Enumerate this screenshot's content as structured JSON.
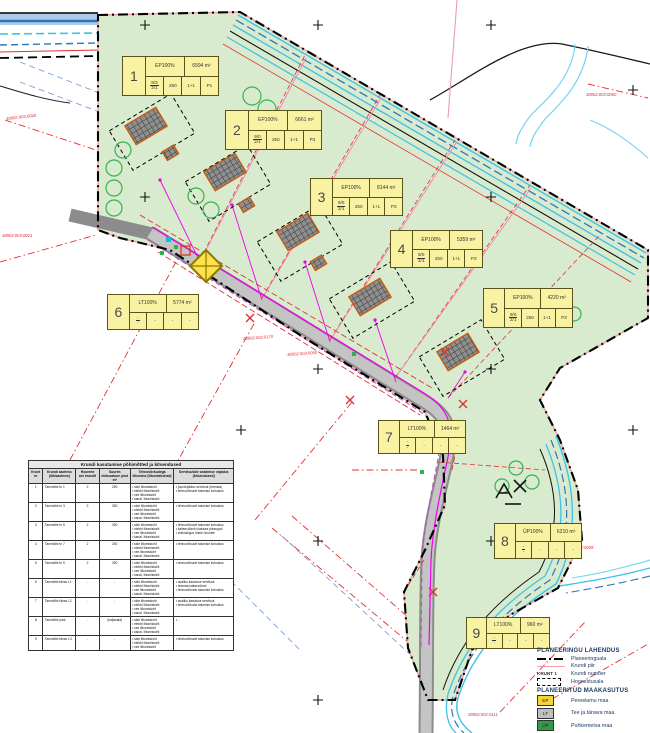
{
  "map": {
    "title_hint": "Detailplaneeringu põhijoonis",
    "plot_labels": [
      {
        "num": "1",
        "use": "EP100%",
        "area": "6594 m²",
        "f_top": "9/3",
        "f_bot": "2/1",
        "c1": "250",
        "c2": "1+1",
        "c3": "P1",
        "x": 122,
        "y": 56,
        "w": 97,
        "h": 40
      },
      {
        "num": "2",
        "use": "EP100%",
        "area": "6661 m²",
        "f_top": "9/0",
        "f_bot": "2/1",
        "c1": "250",
        "c2": "1+1",
        "c3": "P3",
        "x": 225,
        "y": 110,
        "w": 97,
        "h": 40
      },
      {
        "num": "3",
        "use": "EP100%",
        "area": "8144 m²",
        "f_top": "9/0",
        "f_bot": "2/1",
        "c1": "250",
        "c2": "1+1",
        "c3": "P3",
        "x": 310,
        "y": 178,
        "w": 93,
        "h": 38
      },
      {
        "num": "4",
        "use": "EP100%",
        "area": "5359 m²",
        "f_top": "9/0",
        "f_bot": "2/1",
        "c1": "250",
        "c2": "1+1",
        "c3": "P3",
        "x": 390,
        "y": 230,
        "w": 93,
        "h": 38
      },
      {
        "num": "5",
        "use": "EP100%",
        "area": "4220 m²",
        "f_top": "9/0",
        "f_bot": "2/1",
        "c1": "250",
        "c2": "1+1",
        "c3": "P3",
        "x": 483,
        "y": 288,
        "w": 90,
        "h": 40
      },
      {
        "num": "6",
        "use": "LT100%",
        "area": "5774 m²",
        "f_top": "-",
        "f_bot": "-",
        "c1": "-",
        "c2": "-",
        "c3": "-",
        "x": 107,
        "y": 294,
        "w": 92,
        "h": 36
      },
      {
        "num": "7",
        "use": "LT100%",
        "area": "1464 m²",
        "f_top": "-",
        "f_bot": "-",
        "c1": "-",
        "c2": "-",
        "c3": "-",
        "x": 378,
        "y": 420,
        "w": 88,
        "h": 34
      },
      {
        "num": "8",
        "use": "ÜP100%",
        "area": "6210 m²",
        "f_top": "-",
        "f_bot": "-",
        "c1": "-",
        "c2": "-",
        "c3": "-",
        "x": 494,
        "y": 523,
        "w": 88,
        "h": 36
      },
      {
        "num": "9",
        "use": "LT100%",
        "area": "960 m²",
        "f_top": "-",
        "f_bot": "-",
        "c1": "-",
        "c2": "-",
        "c3": "-",
        "x": 466,
        "y": 617,
        "w": 84,
        "h": 32
      }
    ],
    "cadastral_labels": [
      {
        "t": "38902:003:0040",
        "x": 6,
        "y": 116,
        "r": -6
      },
      {
        "t": "38902:003:0021",
        "x": 2,
        "y": 233,
        "r": 0
      },
      {
        "t": "38902:002:0170",
        "x": 243,
        "y": 336,
        "r": -4
      },
      {
        "t": "38902:003:0050",
        "x": 287,
        "y": 352,
        "r": -4
      },
      {
        "t": "38902:003:0060",
        "x": 586,
        "y": 92,
        "r": 0
      },
      {
        "t": "38902:002:0009",
        "x": 563,
        "y": 545,
        "r": 0
      },
      {
        "t": "38902:002:0111",
        "x": 468,
        "y": 712,
        "r": 0
      }
    ]
  },
  "table": {
    "title": "Krundi kasutamise põhimõtted ja kitsendused",
    "headers": [
      "Krunt nr",
      "Krundi aadress (lähiaadress)",
      "Hoonete arv krundil",
      "Suurim ehitusalune pind m²",
      "Tehnovõrkudega liitumine (liitumiskohad)",
      "Servituutide seadmise vajadus (kitsendused)"
    ],
    "rows": [
      {
        "nr": "1",
        "aadress": "Tammiõie tn 1",
        "hooneid": "2",
        "pind": "250",
        "liitumised": [
          "side liitumiskoht",
          "elektri liitumiskoht",
          "vee liitumiskoht",
          "kanal. liitumiskoht"
        ],
        "servituudid": [
          "juurdepääsu servituut (teemaa)",
          "tehnovõrkude talumise kohustus"
        ]
      },
      {
        "nr": "2",
        "aadress": "Tammiõie tn 3",
        "hooneid": "2",
        "pind": "250",
        "liitumised": [
          "side liitumiskoht",
          "elektri liitumiskoht",
          "vee liitumiskoht",
          "kanal. liitumiskoht"
        ],
        "servituudid": [
          "tehnovõrkude talumise kohustus"
        ]
      },
      {
        "nr": "3",
        "aadress": "Tammiõie tn 5",
        "hooneid": "2",
        "pind": "250",
        "liitumised": [
          "side liitumiskoht",
          "elektri liitumiskoht",
          "vee liitumiskoht",
          "kanal. liitumiskoht"
        ],
        "servituudid": [
          "tehnovõrkude talumise kohustus",
          "kaitsevööndi ulatuses piirangud",
          "ehitusõigus ühele hoonele"
        ]
      },
      {
        "nr": "4",
        "aadress": "Tammiõie tn 7",
        "hooneid": "2",
        "pind": "250",
        "liitumised": [
          "side liitumiskoht",
          "elektri liitumiskoht",
          "vee liitumiskoht",
          "kanal. liitumiskoht"
        ],
        "servituudid": [
          "tehnovõrkude talumise kohustus"
        ]
      },
      {
        "nr": "5",
        "aadress": "Tammiõie tn 9",
        "hooneid": "2",
        "pind": "250",
        "liitumised": [
          "side liitumiskoht",
          "elektri liitumiskoht",
          "vee liitumiskoht",
          "kanal. liitumiskoht"
        ],
        "servituudid": [
          "tehnovõrkude talumise kohustus"
        ]
      },
      {
        "nr": "6",
        "aadress": "Tammiõie tänav L1",
        "hooneid": "-",
        "pind": "-",
        "liitumised": [
          "side liitumiskoht",
          "elektri liitumiskoht",
          "vee liitumiskoht",
          "kanal. liitumiskoht"
        ],
        "servituudid": [
          "avaliku kasutuse servituut",
          "teemaa kaitsevöönd",
          "tehnovõrkude talumise kohustus"
        ]
      },
      {
        "nr": "7",
        "aadress": "Tammiõie tänav L2",
        "hooneid": "-",
        "pind": "-",
        "liitumised": [
          "side liitumiskoht",
          "elektri liitumiskoht",
          "vee liitumiskoht",
          "kanal. liitumiskoht"
        ],
        "servituudid": [
          "avaliku kasutuse servituut",
          "tehnovõrkude talumise kohustus"
        ]
      },
      {
        "nr": "8",
        "aadress": "Tammiõie park",
        "hooneid": "-",
        "pind": "(haljasala)",
        "liitumised": [
          "side liitumiskoht",
          "elektri liitumiskoht",
          "vee liitumiskoht",
          "kanal. liitumiskoht"
        ],
        "servituudid": [
          "-"
        ]
      },
      {
        "nr": "9",
        "aadress": "Tammiõie tänav L3",
        "hooneid": "-",
        "pind": "-",
        "liitumised": [
          "side liitumiskoht",
          "elektri liitumiskoht",
          "vee liitumiskoht"
        ],
        "servituudid": [
          "tehnovõrkude talumise kohustus"
        ]
      }
    ]
  },
  "legend": {
    "heading1": "PLANEERINGU LAHENDUS",
    "items1": [
      {
        "type": "dashdot",
        "label": "Planeeringuala"
      },
      {
        "type": "pink",
        "label": "Krundi piir"
      },
      {
        "type": "krunt",
        "symbol_text": "KRUNT 1",
        "label": "Krundi number"
      },
      {
        "type": "dashbox",
        "label": "Hoonestusala"
      }
    ],
    "heading2": "PLANEERITUD MAAKASUTUS",
    "items2": [
      {
        "code": "EP",
        "color": "#f2d437",
        "label": "Pereelamu maa"
      },
      {
        "code": "LT",
        "color": "#bfbfbf",
        "label": "Tee ja tänava maa"
      },
      {
        "code": "ÜP",
        "color": "#2d9e46",
        "label": "Puhkemetsa maa"
      }
    ]
  },
  "colors": {
    "plan_green": "#d8ebcf",
    "stream_cyan": "#3fc1e8",
    "stream_blue": "#2e75b6",
    "road_gray": "#b8b8b8",
    "utility_magenta": "#ee00ee",
    "boundary_black": "#000000",
    "plot_pink": "#f28bb1",
    "alert_red": "#e03131",
    "label_yellow": "#f9f2a2"
  }
}
